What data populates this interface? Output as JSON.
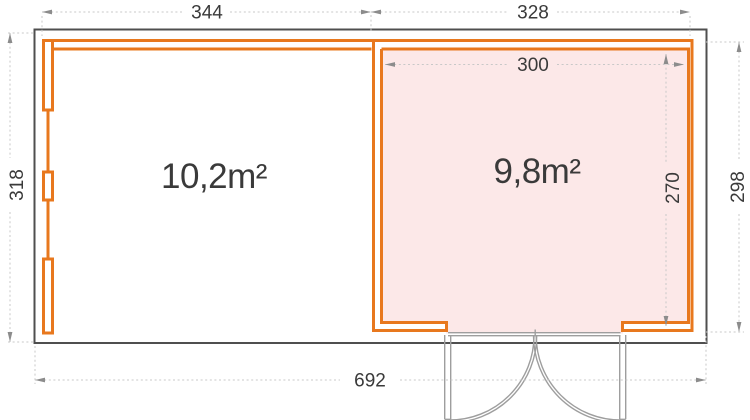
{
  "floorplan": {
    "rooms": [
      {
        "name": "left-room",
        "area_label": "10,2m²"
      },
      {
        "name": "right-room",
        "area_label": "9,8m²"
      }
    ],
    "dimensions": {
      "top_left": "344",
      "top_right": "328",
      "side_left": "318",
      "side_right": "298",
      "inner_width": "300",
      "inner_height": "270",
      "bottom_total": "692"
    },
    "colors": {
      "wall_orange": "#E8781E",
      "room_fill_pink": "#FCE8E8",
      "outline_gray": "#4F4F4F",
      "door_gray": "#9E9E9E",
      "dimension_line_gray": "#C8C8C8",
      "dimension_arrow_gray": "#8C8C8C",
      "text_color": "#3A3A3A"
    }
  }
}
